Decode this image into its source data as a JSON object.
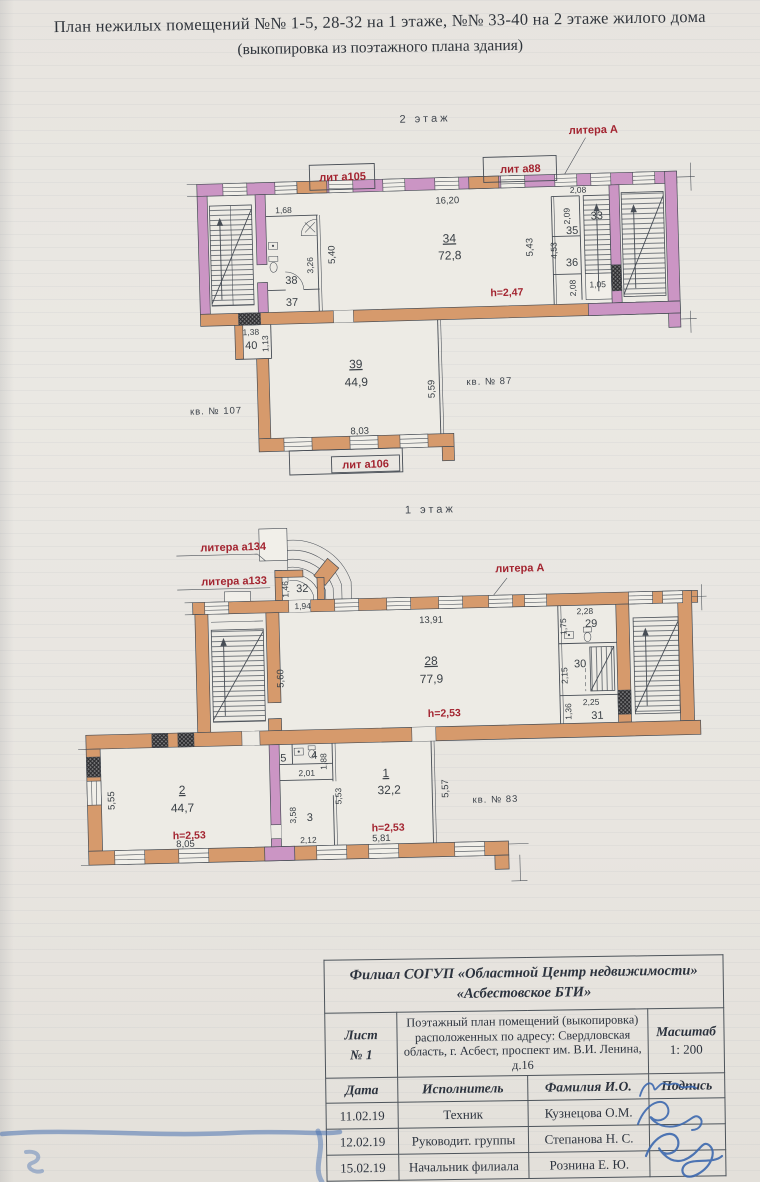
{
  "header": {
    "line1": "План нежилых помещений №№ 1-5, 28-32 на 1 этаже, №№ 33-40 на 2 этаже жилого дома",
    "line2": "(выкопировка из поэтажного плана здания)"
  },
  "colors": {
    "wall_pink": "#cb95c4",
    "wall_orange": "#d69a6c",
    "red_label": "#a32430",
    "ink": "#474d55",
    "table_border": "#4d545b",
    "blue_ink": "#3c68ae"
  },
  "floor2": {
    "annotations": [
      {
        "n": "floor2-label",
        "t": "2 этаж",
        "x": 280,
        "y": 10,
        "c": "floor"
      },
      {
        "n": "litera-a-f2",
        "t": "литера А",
        "x": 448,
        "y": 26,
        "c": "red"
      },
      {
        "n": "lit-a105-label",
        "t": "лит а105",
        "x": 196,
        "y": 66,
        "c": "red"
      },
      {
        "n": "lit-a88-label",
        "t": "лит а88",
        "x": 374,
        "y": 63,
        "c": "red"
      },
      {
        "n": "dim-16-20",
        "t": "16,20",
        "x": 300,
        "y": 92,
        "c": "dim"
      },
      {
        "n": "room-34-number",
        "t": "34",
        "x": 301,
        "y": 131,
        "c": "rnum"
      },
      {
        "n": "room-34-area",
        "t": "72,8",
        "x": 301,
        "y": 148,
        "c": "rval"
      },
      {
        "n": "dim-5-40",
        "t": "5,40",
        "x": 186,
        "y": 140,
        "c": "dimv",
        "r": -90
      },
      {
        "n": "dim-5-43",
        "t": "5,43",
        "x": 384,
        "y": 138,
        "c": "dimv",
        "r": -90
      },
      {
        "n": "dim-1-68",
        "t": "1,68",
        "x": 136,
        "y": 97,
        "c": "sm"
      },
      {
        "n": "dim-3-26",
        "t": "3,26",
        "x": 164,
        "y": 150,
        "c": "smv",
        "r": -90
      },
      {
        "n": "room-38-number",
        "t": "38",
        "x": 142,
        "y": 168,
        "c": "rsm"
      },
      {
        "n": "room-37-number",
        "t": "37",
        "x": 142,
        "y": 190,
        "c": "rsm"
      },
      {
        "n": "h-2-47",
        "t": "h=2,47",
        "x": 357,
        "y": 186,
        "c": "redh"
      },
      {
        "n": "dim-2-08a",
        "t": "2,08",
        "x": 431,
        "y": 85,
        "c": "sm"
      },
      {
        "n": "room-33-number",
        "t": "33",
        "x": 449,
        "y": 112,
        "c": "rsm"
      },
      {
        "n": "dim-2-09",
        "t": "2,09",
        "x": 422,
        "y": 108,
        "c": "smv",
        "r": -90
      },
      {
        "n": "room-35-number",
        "t": "35",
        "x": 424,
        "y": 126,
        "c": "rsm"
      },
      {
        "n": "dim-4-53",
        "t": "4,53",
        "x": 408,
        "y": 142,
        "c": "smv",
        "r": -90
      },
      {
        "n": "room-36-number",
        "t": "36",
        "x": 423,
        "y": 158,
        "c": "rsm"
      },
      {
        "n": "dim-2-08b",
        "t": "2,08",
        "x": 426,
        "y": 180,
        "c": "smv",
        "r": -90
      },
      {
        "n": "dim-1-05",
        "t": "1,05",
        "x": 448,
        "y": 180,
        "c": "sm"
      },
      {
        "n": "dim-1-38",
        "t": "1,38",
        "x": 100,
        "y": 218,
        "c": "sm"
      },
      {
        "n": "room-40-number",
        "t": "40",
        "x": 100,
        "y": 232,
        "c": "rsm"
      },
      {
        "n": "dim-1-13",
        "t": "1,13",
        "x": 117,
        "y": 227,
        "c": "smv",
        "r": -90
      },
      {
        "n": "room-39-number",
        "t": "39",
        "x": 204,
        "y": 254,
        "c": "rnum"
      },
      {
        "n": "room-39-area",
        "t": "44,9",
        "x": 204,
        "y": 272,
        "c": "rval"
      },
      {
        "n": "dim-5-59",
        "t": "5,59",
        "x": 282,
        "y": 277,
        "c": "dimv",
        "r": -90
      },
      {
        "n": "kv-87-label",
        "t": "кв. № 87",
        "x": 337,
        "y": 274,
        "c": "kv"
      },
      {
        "n": "kv-107-label",
        "t": "кв. № 107",
        "x": 63,
        "y": 296,
        "c": "kv"
      },
      {
        "n": "dim-8-03",
        "t": "8,03",
        "x": 206,
        "y": 320,
        "c": "dim"
      },
      {
        "n": "lit-a106-label",
        "t": "лит а106",
        "x": 211,
        "y": 354,
        "c": "red"
      }
    ]
  },
  "floor1": {
    "annotations": [
      {
        "n": "floor1-label",
        "t": "1 этаж",
        "x": 380,
        "y": 14,
        "c": "floor"
      },
      {
        "n": "litera-a134-label",
        "t": "литера а134",
        "x": 182,
        "y": 47,
        "c": "red"
      },
      {
        "n": "litera-a133-label",
        "t": "литера а133",
        "x": 182,
        "y": 81,
        "c": "red"
      },
      {
        "n": "litera-a-f1",
        "t": "литера А",
        "x": 468,
        "y": 75,
        "c": "red"
      },
      {
        "n": "dim-1-46",
        "t": "1,46",
        "x": 236,
        "y": 87,
        "c": "smv",
        "r": -90
      },
      {
        "n": "room-32-number",
        "t": "32",
        "x": 250,
        "y": 90,
        "c": "rsm"
      },
      {
        "n": "dim-1-94",
        "t": "1,94",
        "x": 250,
        "y": 107,
        "c": "sm"
      },
      {
        "n": "dim-13-91",
        "t": "13,91",
        "x": 378,
        "y": 124,
        "c": "dim"
      },
      {
        "n": "room-28-number",
        "t": "28",
        "x": 377,
        "y": 166,
        "c": "rnum"
      },
      {
        "n": "room-28-area",
        "t": "77,9",
        "x": 377,
        "y": 184,
        "c": "rval"
      },
      {
        "n": "dim-5-60",
        "t": "5,60",
        "x": 229,
        "y": 176,
        "c": "dimv",
        "r": -90
      },
      {
        "n": "h-2-53-r28",
        "t": "h=2,53",
        "x": 389,
        "y": 218,
        "c": "redh"
      },
      {
        "n": "dim-2-28",
        "t": "2,28",
        "x": 532,
        "y": 119,
        "c": "sm"
      },
      {
        "n": "room-29-number",
        "t": "29",
        "x": 538,
        "y": 132,
        "c": "rsm"
      },
      {
        "n": "dim-1-75",
        "t": "1,75",
        "x": 513,
        "y": 131,
        "c": "smv",
        "r": -90
      },
      {
        "n": "room-30-number",
        "t": "30",
        "x": 526,
        "y": 172,
        "c": "rsm"
      },
      {
        "n": "dim-2-15",
        "t": "2,15",
        "x": 513,
        "y": 180,
        "c": "smv",
        "r": -90
      },
      {
        "n": "dim-2-25",
        "t": "2,25",
        "x": 536,
        "y": 210,
        "c": "sm"
      },
      {
        "n": "room-31-number",
        "t": "31",
        "x": 542,
        "y": 224,
        "c": "rsm"
      },
      {
        "n": "dim-1-36",
        "t": "1,36",
        "x": 516,
        "y": 216,
        "c": "smv",
        "r": -90
      },
      {
        "n": "room-2-number",
        "t": "2",
        "x": 125,
        "y": 289,
        "c": "rnum"
      },
      {
        "n": "room-2-area",
        "t": "44,7",
        "x": 125,
        "y": 307,
        "c": "rval"
      },
      {
        "n": "h-2-53-r2",
        "t": "h=2,53",
        "x": 131,
        "y": 334,
        "c": "redh"
      },
      {
        "n": "dim-8-05",
        "t": "8,05",
        "x": 127,
        "y": 342,
        "c": "dim"
      },
      {
        "n": "dim-5-55",
        "t": "5,55",
        "x": 57,
        "y": 294,
        "c": "dimv",
        "r": -90
      },
      {
        "n": "room-5-number",
        "t": "5",
        "x": 227,
        "y": 259,
        "c": "rsm"
      },
      {
        "n": "room-4-number",
        "t": "4",
        "x": 258,
        "y": 257,
        "c": "rsm"
      },
      {
        "n": "dim-1-88",
        "t": "1,88",
        "x": 270,
        "y": 260,
        "c": "smv",
        "r": -90
      },
      {
        "n": "dim-2-01",
        "t": "2,01",
        "x": 250,
        "y": 274,
        "c": "sm"
      },
      {
        "n": "dim-3-58",
        "t": "3,58",
        "x": 238,
        "y": 313,
        "c": "smv",
        "r": -90
      },
      {
        "n": "room-3-number",
        "t": "3",
        "x": 252,
        "y": 319,
        "c": "rsm"
      },
      {
        "n": "dim-5-53",
        "t": "5,53",
        "x": 284,
        "y": 295,
        "c": "smv",
        "r": -90
      },
      {
        "n": "dim-2-12",
        "t": "2,12",
        "x": 250,
        "y": 341,
        "c": "sm"
      },
      {
        "n": "room-1-number",
        "t": "1",
        "x": 329,
        "y": 277,
        "c": "rnum"
      },
      {
        "n": "room-1-area",
        "t": "32,2",
        "x": 332,
        "y": 294,
        "c": "rval"
      },
      {
        "n": "h-2-53-r1",
        "t": "h=2,53",
        "x": 330,
        "y": 331,
        "c": "redh"
      },
      {
        "n": "dim-5-81",
        "t": "5,81",
        "x": 323,
        "y": 341,
        "c": "dim"
      },
      {
        "n": "dim-5-57",
        "t": "5,57",
        "x": 391,
        "y": 290,
        "c": "dimv",
        "r": -90
      },
      {
        "n": "kv-83-label",
        "t": "кв. № 83",
        "x": 438,
        "y": 305,
        "c": "kv"
      }
    ]
  },
  "table": {
    "org_line1": "Филиал СОГУП «Областной Центр недвижимости»",
    "org_line2": "«Асбестовское БТИ»",
    "sheet_label": "Лист",
    "sheet_number": "№ 1",
    "description": "Поэтажный план помещений (выкопировка) расположенных по адресу: Свердловская область, г. Асбест, проспект им. В.И. Ленина, д.16",
    "scale_label": "Масштаб",
    "scale_value": "1: 200",
    "columns": [
      "Дата",
      "Исполнитель",
      "Фамилия И.О.",
      "Подпись"
    ],
    "rows": [
      {
        "date": "11.02.19",
        "role": "Техник",
        "name": "Кузнецова О.М."
      },
      {
        "date": "12.02.19",
        "role": "Руководит. группы",
        "name": "Степанова Н. С."
      },
      {
        "date": "15.02.19",
        "role": "Начальник филиала",
        "name": "Рознина Е. Ю."
      }
    ]
  }
}
